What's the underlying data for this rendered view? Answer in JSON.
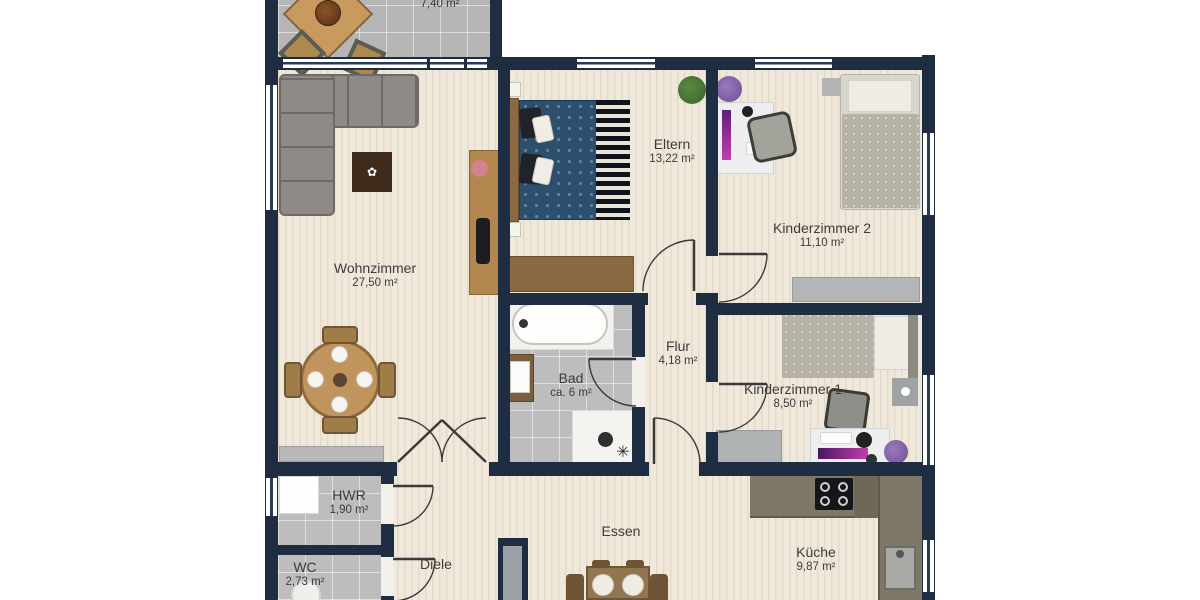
{
  "floorplan": {
    "rooms": [
      {
        "name": "",
        "area": "7,40 m²"
      },
      {
        "name": "Wohnzimmer",
        "area": "27,50 m²"
      },
      {
        "name": "Eltern",
        "area": "13,22 m²"
      },
      {
        "name": "Kinderzimmer 2",
        "area": "11,10 m²"
      },
      {
        "name": "Kinderzimmer 1",
        "area": "8,50 m²"
      },
      {
        "name": "Flur",
        "area": "4,18 m²"
      },
      {
        "name": "Bad",
        "area": "ca. 6 m²"
      },
      {
        "name": "HWR",
        "area": "1,90 m²"
      },
      {
        "name": "WC",
        "area": "2,73 m²"
      },
      {
        "name": "Diele",
        "area": ""
      },
      {
        "name": "Essen",
        "area": ""
      },
      {
        "name": "Küche",
        "area": "9,87 m²"
      }
    ],
    "colors": {
      "wall": "#1f2d42",
      "wood_floor": "#f0e9db",
      "tile_floor": "#bdbdbd",
      "label_text": "#3c3c3c",
      "parents_bed": "#2c4f6e",
      "kitchen_counter": "#7e7767"
    }
  }
}
